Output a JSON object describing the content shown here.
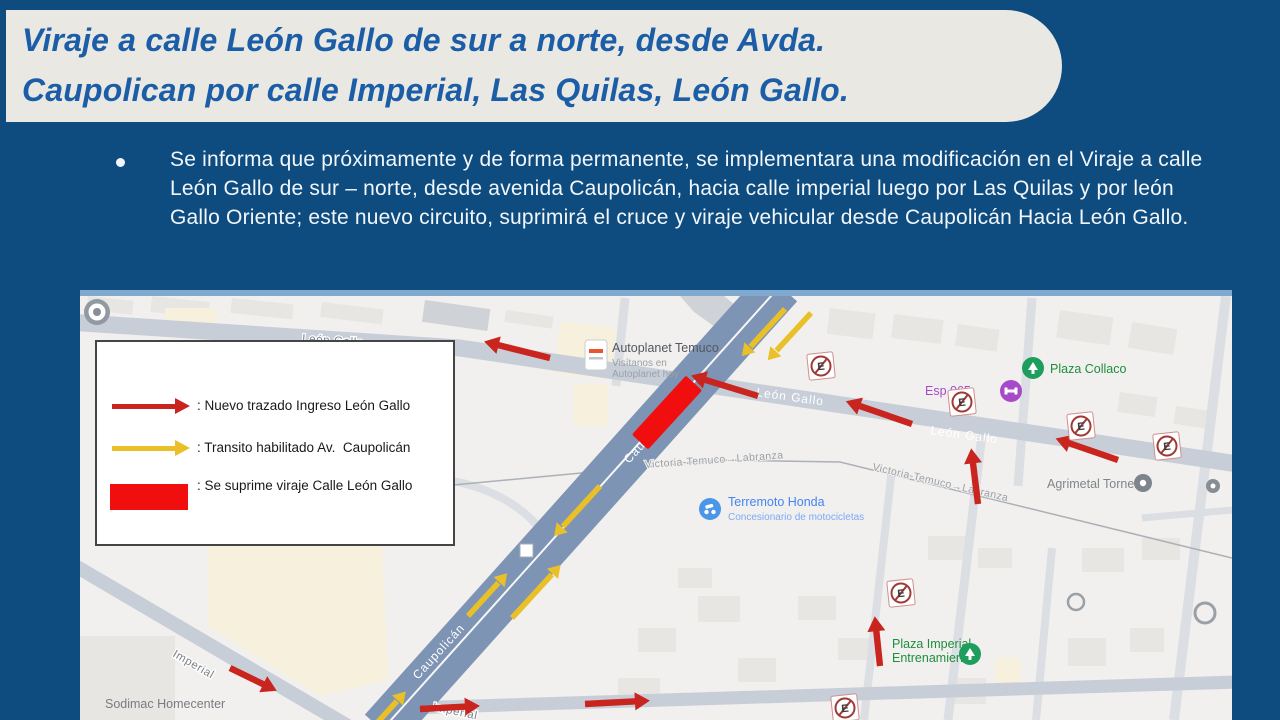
{
  "colors": {
    "background": "#0E4C80",
    "banner": "#EAE8E2",
    "header_text": "#1B5EA7",
    "body_text": "#F2F6FA",
    "red_arrow": "#C9241E",
    "yellow_arrow": "#EAC028",
    "suppress_red": "#F10E0E",
    "avenue": "#7E94B4",
    "road": "#C8CED8"
  },
  "header": {
    "line1": "Viraje a calle León Gallo de sur a norte, desde Avda.",
    "line2": "Caupolican por calle Imperial, Las Quilas, León Gallo."
  },
  "body": {
    "bullet_text": "Se informa que próximamente y de forma permanente, se implementara una modificación en el Viraje a calle León Gallo de sur – norte, desde avenida Caupolicán, hacia calle imperial luego por Las Quilas y por león Gallo Oriente; este nuevo circuito, suprimirá el cruce y viraje vehicular desde Caupolicán Hacia León Gallo."
  },
  "legend": {
    "items": [
      {
        "swatch": "red-arrow",
        "label": ": Nuevo trazado Ingreso León Gallo"
      },
      {
        "swatch": "yellow-arrow",
        "label": ": Transito habilitado Av.  Caupolicán"
      },
      {
        "swatch": "red-block",
        "label": ": Se suprime viraje Calle León Gallo"
      }
    ]
  },
  "map": {
    "sign_letter": "E",
    "streets": {
      "leon_gallo_w": "León Gallo",
      "leon_gallo_m": "León Gallo",
      "leon_gallo_e": "León Gallo",
      "caupolican_1": "Caupolicán",
      "caupolican_2": "Caupolicán",
      "imperial_1": "Imperial",
      "imperial_2": "Imperial",
      "victoria_1": "Victoria-Temuco→Labranza",
      "victoria_2": "Victoria-Temuco→Labranza"
    },
    "pois": {
      "autoplanet_title": "Autoplanet Temuco",
      "autoplanet_sub1": "Visítanos en",
      "autoplanet_sub2": "Autoplanet hoy",
      "terremoto_title": "Terremoto Honda",
      "terremoto_sub": "Concesionario de motocicletas",
      "plaza_collaco": "Plaza Collaco",
      "espacio": "Esp 065",
      "agrimetal": "Agrimetal Tornería",
      "plaza_imperial_1": "Plaza Imperial",
      "plaza_imperial_2": "Entrenamiento",
      "sodimac": "Sodimac Homecenter"
    }
  }
}
